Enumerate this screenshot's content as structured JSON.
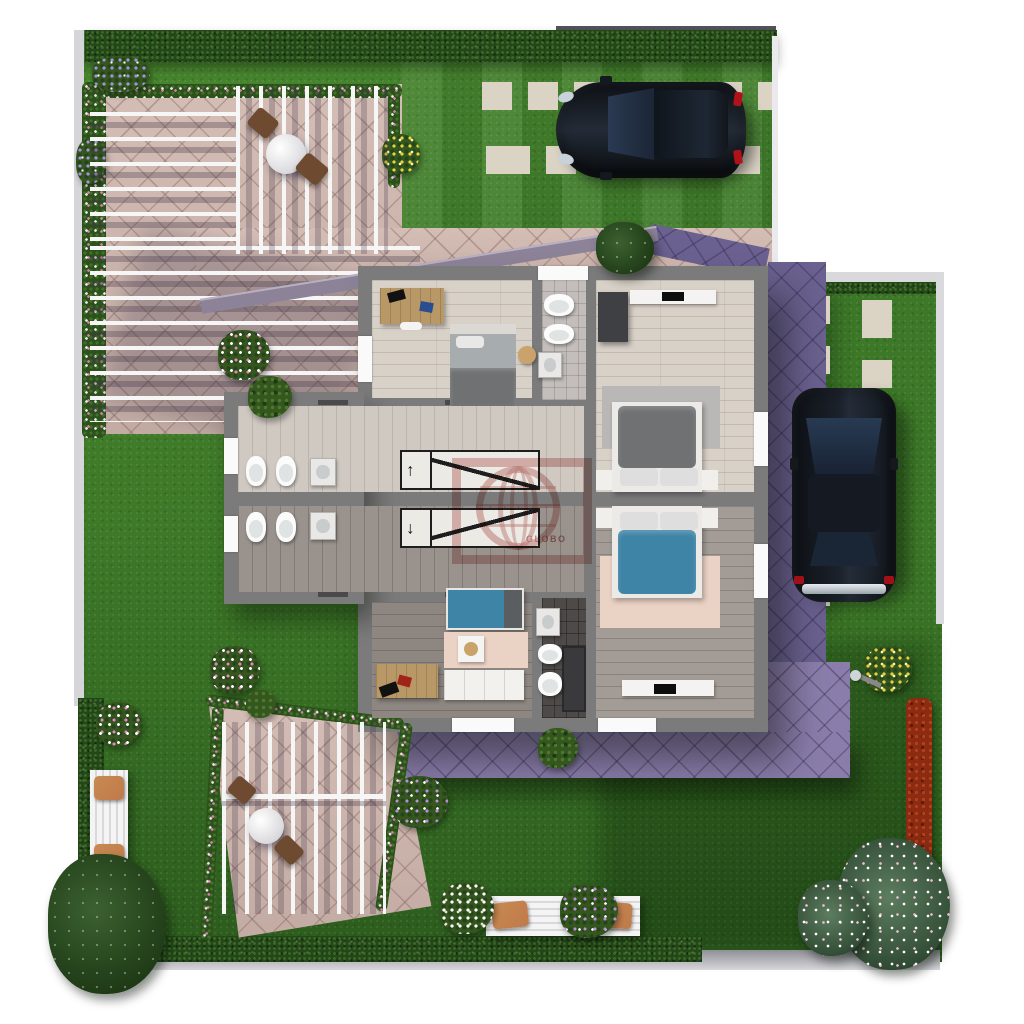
{
  "watermark": {
    "brand": "GLOBO"
  },
  "palette": {
    "lawn": "#3c7827",
    "hedge": "#24471a",
    "tile": "#cfb6ad",
    "roof": "#8a7dab",
    "roofDark": "#6b6190",
    "trim": "#8d8398",
    "wall": "#7b7b7b",
    "floorLight": "#d8d1c8",
    "hallTop": "#cfc9c2",
    "hallBottom": "#9a938d",
    "floorBL": "#8e8781",
    "floorBR": "#a39c96",
    "bathLight": "#c3bebb",
    "bathDark": "#4d4a48",
    "slat": "#f6f6f7",
    "paver": "#dbd3c4",
    "carBody": "#161b22",
    "carGlass": "#22303f",
    "bedTeal": "#3e84a6",
    "bedGray": "#6f7173",
    "rugPink": "#ead3c5",
    "rugGray": "#bab8b6",
    "deskWood": "#b99868",
    "cushion": "#bf7a4a",
    "redHedge": "#8a2b12",
    "fixture": "#fbfbfb",
    "stairLine": "#1e1e1e",
    "watermark": "#a6322b"
  }
}
